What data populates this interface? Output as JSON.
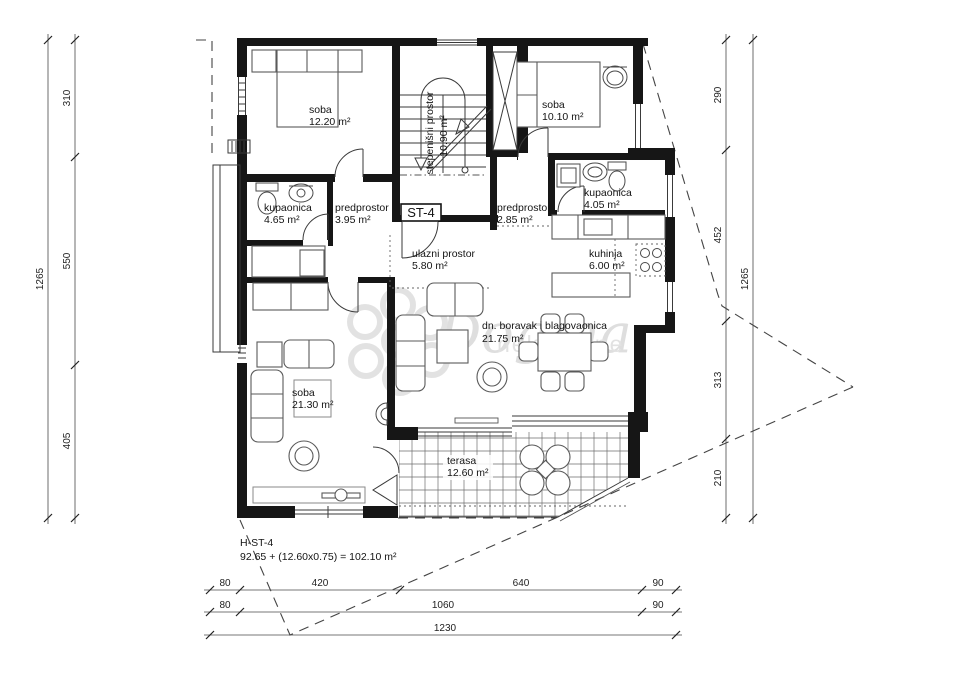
{
  "plan": {
    "unit_label": "ST-4",
    "footer": {
      "code": "H-ST-4",
      "formula": "92.65 + (12.60x0.75) = 102.10 m²"
    },
    "watermark": {
      "brand": "Dogma",
      "sub": "nekretnine"
    },
    "rooms": [
      {
        "id": "soba-1",
        "name": "soba",
        "area": "12.20 m²"
      },
      {
        "id": "stepenisni-prostor",
        "name": "stepenišni prostor",
        "area": "10.90 m²"
      },
      {
        "id": "soba-2",
        "name": "soba",
        "area": "10.10 m²"
      },
      {
        "id": "kupaonica-1",
        "name": "kupaonica",
        "area": "4.65 m²"
      },
      {
        "id": "predprostor-1",
        "name": "predprostor",
        "area": "3.95 m²"
      },
      {
        "id": "predprostor-2",
        "name": "predprostor",
        "area": "2.85 m²"
      },
      {
        "id": "kupaonica-2",
        "name": "kupaonica",
        "area": "4.05 m²"
      },
      {
        "id": "ulazni-prostor",
        "name": "ulazni prostor",
        "area": "5.80 m²"
      },
      {
        "id": "kuhinja",
        "name": "kuhinja",
        "area": "6.00 m²"
      },
      {
        "id": "dnevni-boravak",
        "name": "dn. boravak i blagovaonica",
        "area": "21.75 m²"
      },
      {
        "id": "soba-3",
        "name": "soba",
        "area": "21.30 m²"
      },
      {
        "id": "terasa",
        "name": "terasa",
        "area": "12.60 m²"
      }
    ],
    "dims": {
      "left": {
        "total": "1265",
        "segments": [
          "310",
          "550",
          "405"
        ]
      },
      "right": {
        "total": "1265",
        "segments": [
          "290",
          "452",
          "313",
          "210"
        ]
      },
      "bottom": {
        "row1": [
          "80",
          "420",
          "640",
          "90"
        ],
        "row2": [
          "80",
          "1060",
          "90"
        ],
        "row3": [
          "1230"
        ]
      }
    }
  }
}
